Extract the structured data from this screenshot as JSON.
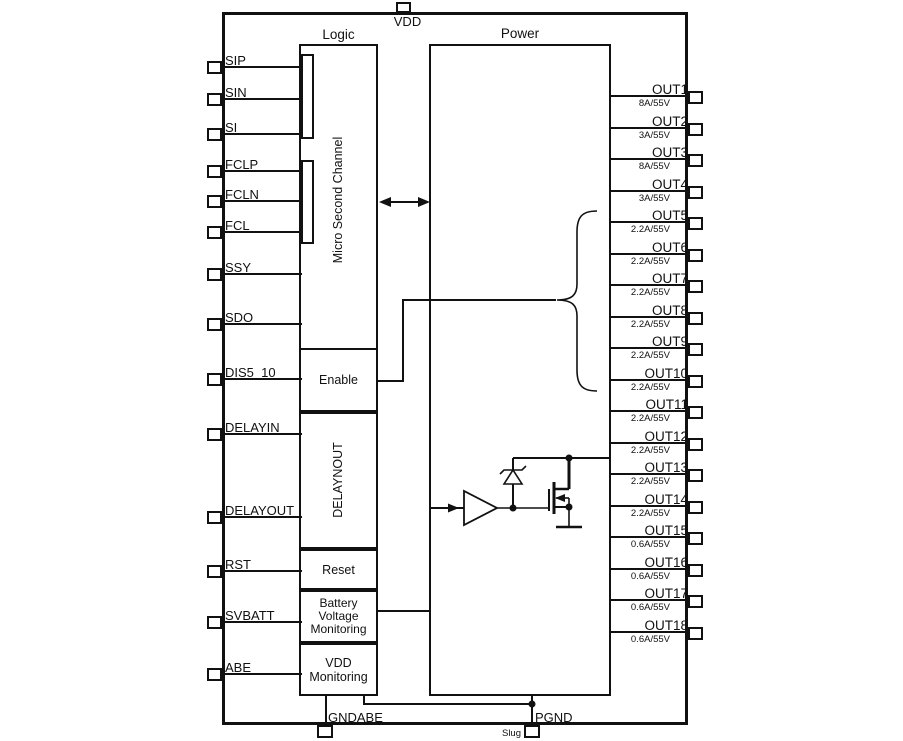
{
  "chip": {
    "logic_label": "Logic",
    "power_label": "Power"
  },
  "top_pin": {
    "label": "VDD"
  },
  "left_pins": [
    {
      "label": "SIP"
    },
    {
      "label": "SIN"
    },
    {
      "label": "SI"
    },
    {
      "label": "FCLP"
    },
    {
      "label": "FCLN"
    },
    {
      "label": "FCL"
    },
    {
      "label": "SSY"
    },
    {
      "label": "SDO"
    },
    {
      "label": "DIS5_10"
    },
    {
      "label": "DELAYIN"
    },
    {
      "label": "DELAYOUT"
    },
    {
      "label": "RST"
    },
    {
      "label": "SVBATT"
    },
    {
      "label": "ABE"
    }
  ],
  "outputs": [
    {
      "name": "OUT1",
      "rating": "8A/55V"
    },
    {
      "name": "OUT2",
      "rating": "3A/55V"
    },
    {
      "name": "OUT3",
      "rating": "8A/55V"
    },
    {
      "name": "OUT4",
      "rating": "3A/55V"
    },
    {
      "name": "OUT5",
      "rating": "2.2A/55V"
    },
    {
      "name": "OUT6",
      "rating": "2.2A/55V"
    },
    {
      "name": "OUT7",
      "rating": "2.2A/55V"
    },
    {
      "name": "OUT8",
      "rating": "2.2A/55V"
    },
    {
      "name": "OUT9",
      "rating": "2.2A/55V"
    },
    {
      "name": "OUT10",
      "rating": "2.2A/55V"
    },
    {
      "name": "OUT11",
      "rating": "2.2A/55V"
    },
    {
      "name": "OUT12",
      "rating": "2.2A/55V"
    },
    {
      "name": "OUT13",
      "rating": "2.2A/55V"
    },
    {
      "name": "OUT14",
      "rating": "2.2A/55V"
    },
    {
      "name": "OUT15",
      "rating": "0.6A/55V"
    },
    {
      "name": "OUT16",
      "rating": "0.6A/55V"
    },
    {
      "name": "OUT17",
      "rating": "0.6A/55V"
    },
    {
      "name": "OUT18",
      "rating": "0.6A/55V"
    }
  ],
  "logic_blocks": {
    "channel": "Micro Second Channel",
    "enable": "Enable",
    "delay": "DELAYNOUT",
    "reset": "Reset",
    "battery": "Battery Voltage Monitoring",
    "vdd_monitoring": "VDD Monitoring"
  },
  "bottom_pins": {
    "gndabe": "GNDABE",
    "pgnd": "PGND",
    "slug": "Slug"
  },
  "colors": {
    "line": "#111111",
    "background": "#ffffff"
  }
}
